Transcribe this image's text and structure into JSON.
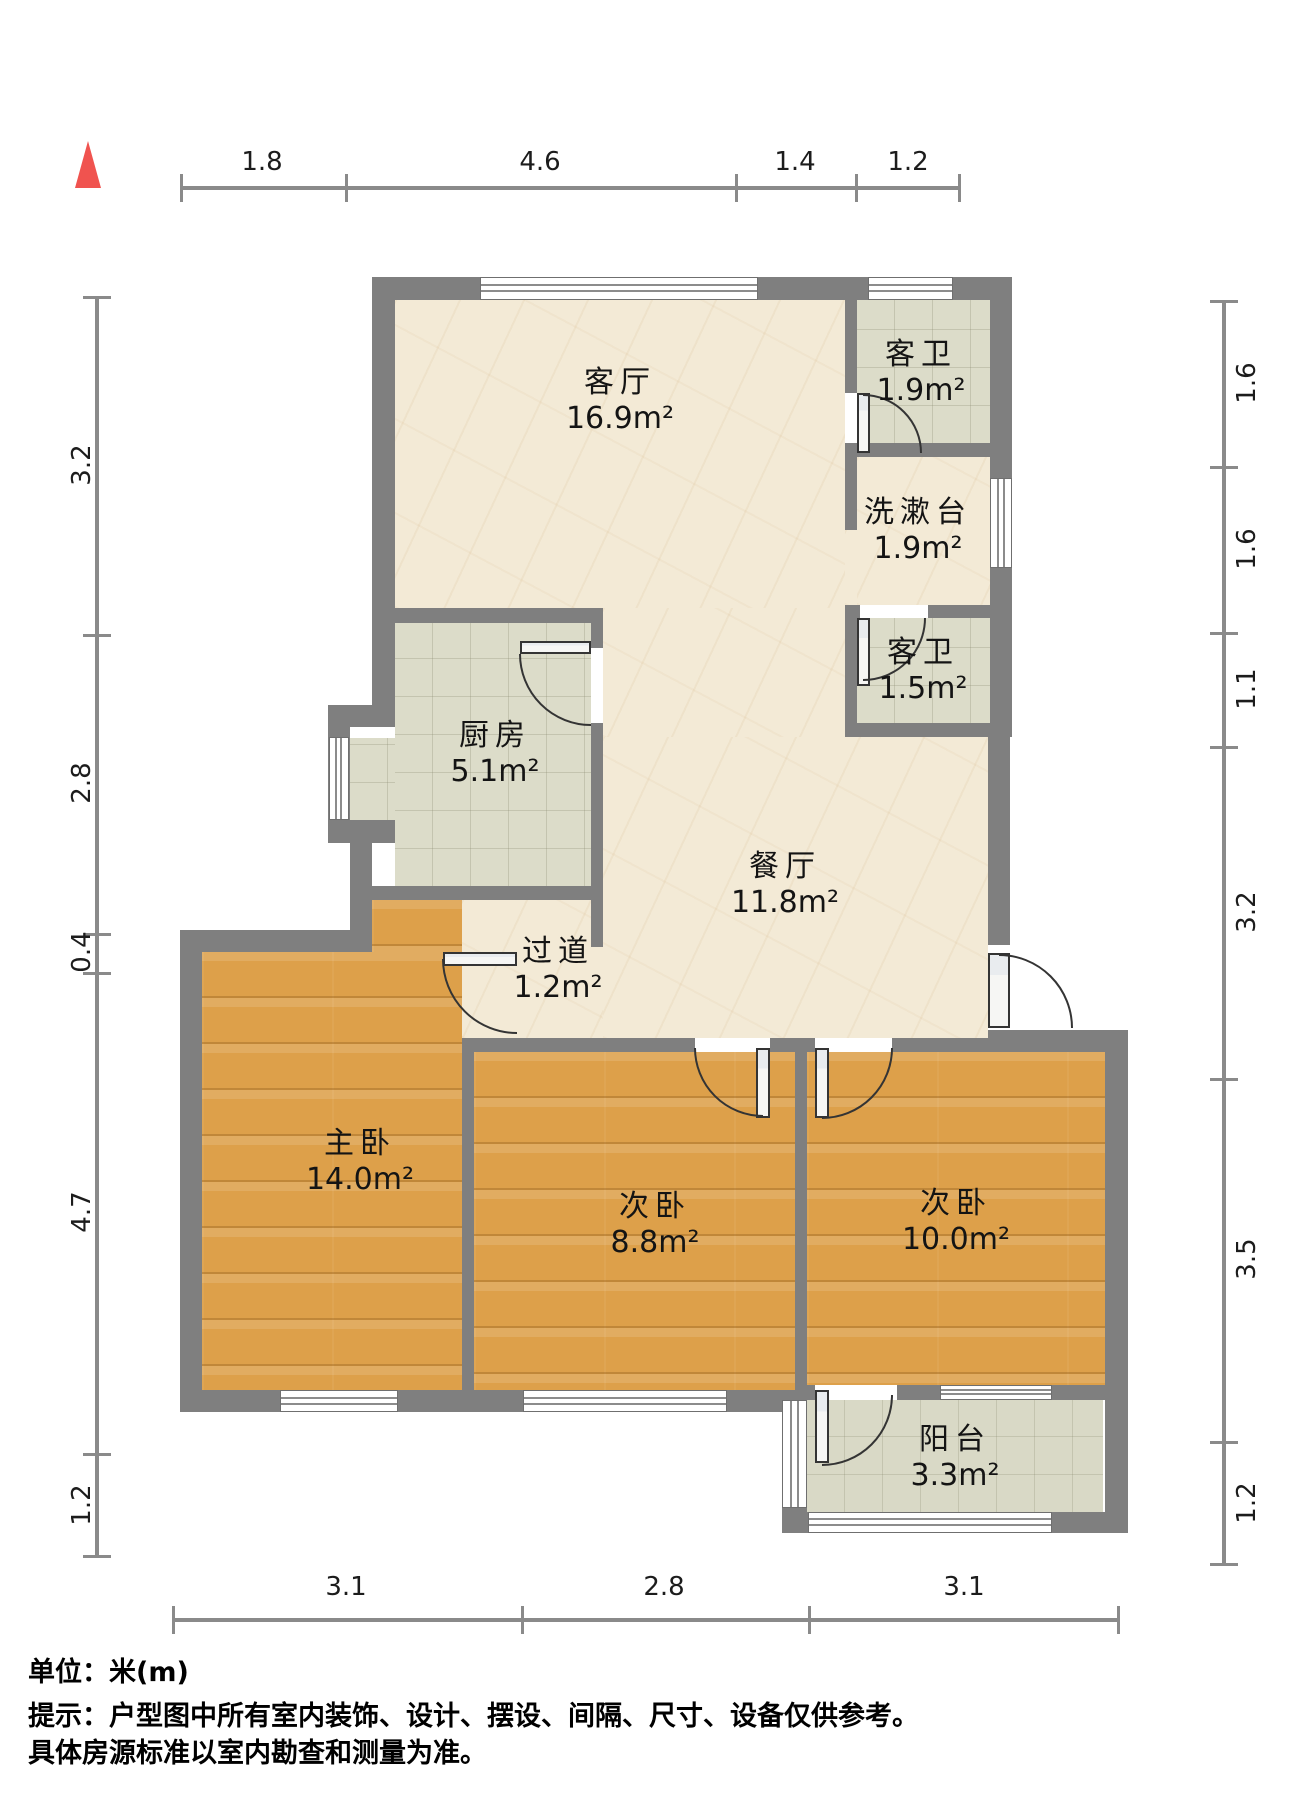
{
  "compass": {
    "color": "#f0534f",
    "direction": "north"
  },
  "rooms": [
    {
      "id": "living",
      "name": "客厅",
      "area": "16.9m²"
    },
    {
      "id": "bath_top",
      "name": "客卫",
      "area": "1.9m²"
    },
    {
      "id": "washstand",
      "name": "洗漱台",
      "area": "1.9m²"
    },
    {
      "id": "bath_mid",
      "name": "客卫",
      "area": "1.5m²"
    },
    {
      "id": "kitchen",
      "name": "厨房",
      "area": "5.1m²"
    },
    {
      "id": "dining",
      "name": "餐厅",
      "area": "11.8m²"
    },
    {
      "id": "corridor",
      "name": "过道",
      "area": "1.2m²"
    },
    {
      "id": "master",
      "name": "主卧",
      "area": "14.0m²"
    },
    {
      "id": "bed2",
      "name": "次卧",
      "area": "8.8m²"
    },
    {
      "id": "bed3",
      "name": "次卧",
      "area": "10.0m²"
    },
    {
      "id": "balcony",
      "name": "阳台",
      "area": "3.3m²"
    }
  ],
  "dimensions": {
    "top": [
      "1.8",
      "4.6",
      "1.4",
      "1.2"
    ],
    "left": [
      "3.2",
      "2.8",
      "0.4",
      "4.7",
      "1.2"
    ],
    "right": [
      "1.6",
      "1.6",
      "1.1",
      "3.2",
      "3.5",
      "1.2"
    ],
    "bottom": [
      "3.1",
      "2.8",
      "3.1"
    ]
  },
  "footer": {
    "unit_label": "单位：米(m)",
    "note_line1": "提示：户型图中所有室内装饰、设计、摆设、间隔、尺寸、设备仅供参考。",
    "note_line2": "具体房源标准以室内勘查和测量为准。"
  },
  "colors": {
    "wall": "#7f7f7f",
    "floor_marble": "#f3ead6",
    "floor_tile": "#dcdcc9",
    "floor_wood": "#dda04a",
    "compass_red": "#f0534f",
    "dim_line": "#8a8a8a"
  }
}
